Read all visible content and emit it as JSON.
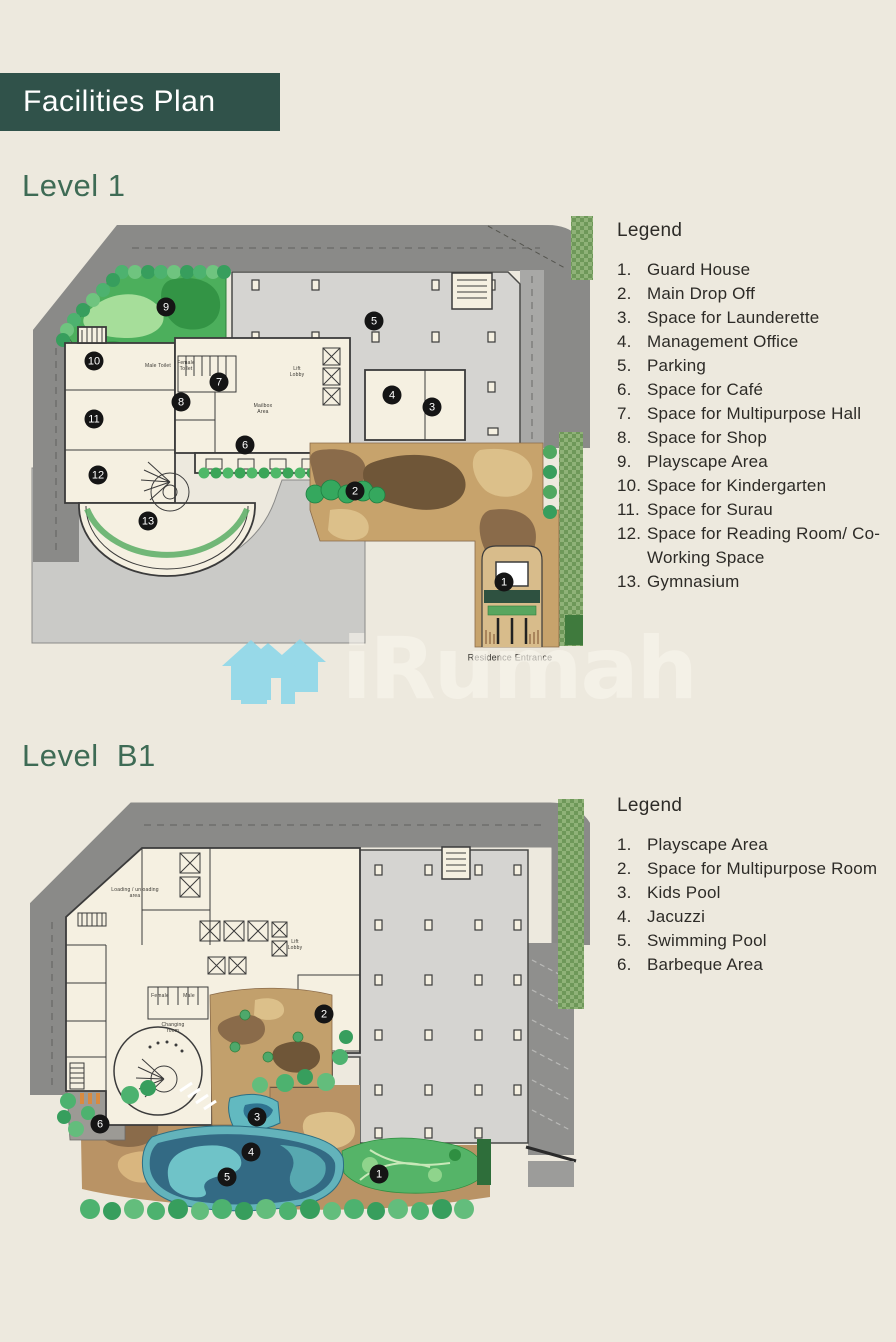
{
  "header": {
    "title": "Facilities Plan"
  },
  "colors": {
    "page_background": "#EDE9DE",
    "header_band": "#30524A",
    "heading_green": "#3E6B55",
    "marker_black": "#151515",
    "watermark_blue": "#8CD7EA",
    "road_gray": "#8A8A88",
    "parking_gray": "#D5D4D1",
    "building_cream": "#F5F0E1",
    "landscape_brown": "#C7A36C",
    "pool_blue": "#336A84",
    "canopy_green": "#2E5140"
  },
  "watermark": {
    "brand": "iRumah",
    "icon": "house-icon"
  },
  "sections": {
    "level1": {
      "heading": "Level 1",
      "legend": {
        "title": "Legend",
        "items": [
          {
            "num": "1.",
            "label": "Guard House"
          },
          {
            "num": "2.",
            "label": "Main Drop Off"
          },
          {
            "num": "3.",
            "label": "Space for Launderette"
          },
          {
            "num": "4.",
            "label": "Management Office"
          },
          {
            "num": "5.",
            "label": "Parking"
          },
          {
            "num": "6.",
            "label": "Space for Café"
          },
          {
            "num": "7.",
            "label": "Space for Multipurpose Hall"
          },
          {
            "num": "8.",
            "label": "Space for Shop"
          },
          {
            "num": "9.",
            "label": "Playscape Area"
          },
          {
            "num": "10.",
            "label": "Space for Kindergarten"
          },
          {
            "num": "11.",
            "label": "Space for Surau"
          },
          {
            "num": "12.",
            "label": "Space for Reading Room/ Co-Working Space"
          },
          {
            "num": "13.",
            "label": "Gymnasium"
          }
        ]
      },
      "plan": {
        "markers": [
          {
            "n": "9",
            "x": 146,
            "y": 97
          },
          {
            "n": "5",
            "x": 354,
            "y": 111
          },
          {
            "n": "10",
            "x": 74,
            "y": 151
          },
          {
            "n": "7",
            "x": 199,
            "y": 172
          },
          {
            "n": "4",
            "x": 372,
            "y": 185
          },
          {
            "n": "8",
            "x": 161,
            "y": 192
          },
          {
            "n": "3",
            "x": 412,
            "y": 197
          },
          {
            "n": "11",
            "x": 74,
            "y": 209
          },
          {
            "n": "6",
            "x": 225,
            "y": 235
          },
          {
            "n": "12",
            "x": 78,
            "y": 265
          },
          {
            "n": "2",
            "x": 335,
            "y": 281
          },
          {
            "n": "13",
            "x": 128,
            "y": 311
          },
          {
            "n": "1",
            "x": 484,
            "y": 372
          }
        ],
        "labels": [
          {
            "text": "Male Toilet",
            "x": 138,
            "y": 157,
            "size": 5
          },
          {
            "text": "Female\nToilet",
            "x": 166,
            "y": 157,
            "size": 5
          },
          {
            "text": "Lift\nLobby",
            "x": 277,
            "y": 163,
            "size": 5
          },
          {
            "text": "Mailbox\nArea",
            "x": 243,
            "y": 200,
            "size": 5
          },
          {
            "text": "Residence Entrance",
            "x": 490,
            "y": 448,
            "size": 9
          }
        ]
      }
    },
    "levelb1": {
      "heading": "Level  B1",
      "legend": {
        "title": "Legend",
        "items": [
          {
            "num": "1.",
            "label": "Playscape Area"
          },
          {
            "num": "2.",
            "label": "Space for Multipurpose Room"
          },
          {
            "num": "3.",
            "label": "Kids Pool"
          },
          {
            "num": "4.",
            "label": "Jacuzzi"
          },
          {
            "num": "5.",
            "label": "Swimming Pool"
          },
          {
            "num": "6.",
            "label": "Barbeque Area"
          }
        ]
      },
      "plan": {
        "markers": [
          {
            "n": "2",
            "x": 294,
            "y": 219
          },
          {
            "n": "3",
            "x": 227,
            "y": 322
          },
          {
            "n": "6",
            "x": 70,
            "y": 329
          },
          {
            "n": "4",
            "x": 221,
            "y": 357
          },
          {
            "n": "1",
            "x": 349,
            "y": 379
          },
          {
            "n": "5",
            "x": 197,
            "y": 382
          }
        ],
        "labels": [
          {
            "text": "Loading / unloading\narea",
            "x": 105,
            "y": 99,
            "size": 5
          },
          {
            "text": "Lift\nLobby",
            "x": 265,
            "y": 151,
            "size": 5
          },
          {
            "text": "Female",
            "x": 130,
            "y": 202,
            "size": 5
          },
          {
            "text": "Male",
            "x": 159,
            "y": 202,
            "size": 5
          },
          {
            "text": "Changing\nroom",
            "x": 143,
            "y": 234,
            "size": 5
          }
        ]
      }
    }
  }
}
